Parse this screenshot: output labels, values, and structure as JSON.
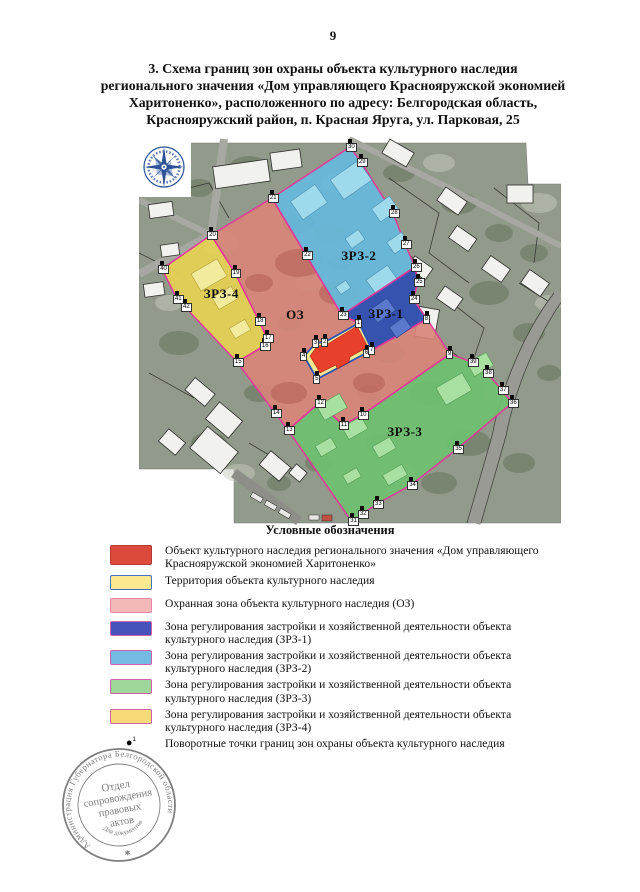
{
  "page": {
    "number": "9"
  },
  "title": {
    "lines": [
      "3. Схема границ зон охраны объекта культурного наследия",
      "регионального значения «Дом управляющего Краснояружской экономией",
      "Харитоненко», расположенного по адресу: Белгородская область,",
      "Краснояружский район, п. Красная Яруга, ул. Парковая, 25"
    ]
  },
  "map": {
    "zones": {
      "oz": {
        "name": "ОЗ",
        "color": "#d98579"
      },
      "zrz1": {
        "name": "ЗРЗ-1",
        "color": "#3350b2"
      },
      "zrz2": {
        "name": "ЗРЗ-2",
        "color": "#66b9dd"
      },
      "zrz3": {
        "name": "ЗРЗ-3",
        "color": "#6fc06f"
      },
      "zrz4": {
        "name": "ЗРЗ-4",
        "color": "#e6d254"
      },
      "object": {
        "name": "Объект культурного наследия",
        "color": "#e8402a"
      },
      "territory": {
        "name": "Территория объекта",
        "color": "#f4e88e",
        "border": "#2b52b8"
      },
      "boundary_color": "#e8359a"
    },
    "zone_labels": [
      {
        "text": "ЗРЗ-2",
        "x": 52.1,
        "y": 31.3
      },
      {
        "text": "ЗРЗ-1",
        "x": 58.5,
        "y": 46.6
      },
      {
        "text": "ОЗ",
        "x": 37.0,
        "y": 46.8
      },
      {
        "text": "ЗРЗ-4",
        "x": 19.5,
        "y": 41.3
      },
      {
        "text": "ЗРЗ-3",
        "x": 63.0,
        "y": 77.6
      }
    ],
    "points": [
      {
        "n": "1",
        "x": 52.1,
        "y": 47.4
      },
      {
        "n": "2",
        "x": 44.1,
        "y": 52.4
      },
      {
        "n": "3",
        "x": 41.9,
        "y": 52.6
      },
      {
        "n": "4",
        "x": 39.1,
        "y": 56.1
      },
      {
        "n": "5",
        "x": 42.2,
        "y": 62.1
      },
      {
        "n": "6",
        "x": 54.0,
        "y": 55.3
      },
      {
        "n": "7",
        "x": 55.2,
        "y": 54.5
      },
      {
        "n": "8",
        "x": 68.2,
        "y": 46.3
      },
      {
        "n": "9",
        "x": 73.7,
        "y": 55.5
      },
      {
        "n": "10",
        "x": 52.8,
        "y": 71.6
      },
      {
        "n": "11",
        "x": 48.3,
        "y": 74.2
      },
      {
        "n": "12",
        "x": 42.7,
        "y": 68.4
      },
      {
        "n": "13",
        "x": 35.3,
        "y": 75.5
      },
      {
        "n": "14",
        "x": 32.2,
        "y": 71.1
      },
      {
        "n": "15",
        "x": 23.2,
        "y": 57.6
      },
      {
        "n": "16",
        "x": 29.6,
        "y": 53.4
      },
      {
        "n": "17",
        "x": 30.3,
        "y": 51.3
      },
      {
        "n": "18",
        "x": 28.4,
        "y": 46.8
      },
      {
        "n": "19",
        "x": 22.7,
        "y": 34.2
      },
      {
        "n": "20",
        "x": 17.1,
        "y": 24.2
      },
      {
        "n": "21",
        "x": 31.5,
        "y": 14.5
      },
      {
        "n": "22",
        "x": 39.6,
        "y": 29.5
      },
      {
        "n": "23",
        "x": 48.1,
        "y": 45.3
      },
      {
        "n": "24",
        "x": 64.9,
        "y": 41.1
      },
      {
        "n": "25",
        "x": 66.1,
        "y": 36.6
      },
      {
        "n": "26",
        "x": 65.4,
        "y": 32.6
      },
      {
        "n": "27",
        "x": 63.0,
        "y": 26.6
      },
      {
        "n": "28",
        "x": 60.2,
        "y": 18.4
      },
      {
        "n": "29",
        "x": 52.6,
        "y": 5.0
      },
      {
        "n": "30",
        "x": 50.0,
        "y": 1.1
      },
      {
        "n": "31",
        "x": 50.5,
        "y": 99.4
      },
      {
        "n": "32",
        "x": 52.8,
        "y": 97.6
      },
      {
        "n": "33",
        "x": 56.4,
        "y": 95.0
      },
      {
        "n": "34",
        "x": 64.5,
        "y": 90.0
      },
      {
        "n": "35",
        "x": 75.4,
        "y": 80.5
      },
      {
        "n": "36",
        "x": 88.4,
        "y": 68.4
      },
      {
        "n": "37",
        "x": 86.0,
        "y": 65.0
      },
      {
        "n": "38",
        "x": 82.5,
        "y": 60.5
      },
      {
        "n": "39",
        "x": 78.9,
        "y": 57.6
      },
      {
        "n": "40",
        "x": 5.5,
        "y": 33.2
      },
      {
        "n": "41",
        "x": 9.0,
        "y": 41.1
      },
      {
        "n": "42",
        "x": 10.9,
        "y": 43.2
      }
    ]
  },
  "legend": {
    "heading": "Условные обозначения",
    "items": [
      {
        "fill": "#dc4a3e",
        "border": "#b43a32",
        "pattern": "none",
        "height": "tall",
        "text": "Объект культурного наследия регионального значения «Дом управляющего Краснояружской экономией Харитоненко»"
      },
      {
        "fill": "#fae98e",
        "border": "#4a72c0",
        "pattern": "none",
        "height": "normal",
        "text": "Территория объекта культурного наследия"
      },
      {
        "fill": "#f3b9b6",
        "border": "#e884a8",
        "pattern": "dots",
        "height": "normal",
        "text": "Охранная зона объекта культурного наследия (ОЗ)"
      },
      {
        "fill": "#4553bb",
        "border": "#d060a8",
        "pattern": "dots",
        "height": "normal",
        "text": "Зона регулирования застройки и хозяйственной деятельности объекта культурного наследия (ЗРЗ-1)"
      },
      {
        "fill": "#74bbe4",
        "border": "#d060a8",
        "pattern": "none",
        "height": "normal",
        "text": "Зона регулирования застройки и хозяйственной деятельности объекта культурного наследия (ЗРЗ-2)"
      },
      {
        "fill": "#9ed69b",
        "border": "#d060a8",
        "pattern": "none",
        "height": "normal",
        "text": "Зона регулирования застройки и хозяйственной деятельности объекта культурного наследия (ЗРЗ-3)"
      },
      {
        "fill": "#f9da79",
        "border": "#d060a8",
        "pattern": "none",
        "height": "normal",
        "text": "Зона регулирования застройки и хозяйственной деятельности объекта культурного наследия (ЗРЗ-4)"
      },
      {
        "marker": "●",
        "marker_sup": "1",
        "text": "Поворотные точки границ зон охраны объекта культурного наследия"
      }
    ]
  },
  "stamp": {
    "ring_text": "Администрация Губернатора Белгородской области",
    "doc_text": "Для документов",
    "star": "✱",
    "center_lines": [
      "Отдел",
      "сопровождения",
      "правовых",
      "актов"
    ]
  }
}
